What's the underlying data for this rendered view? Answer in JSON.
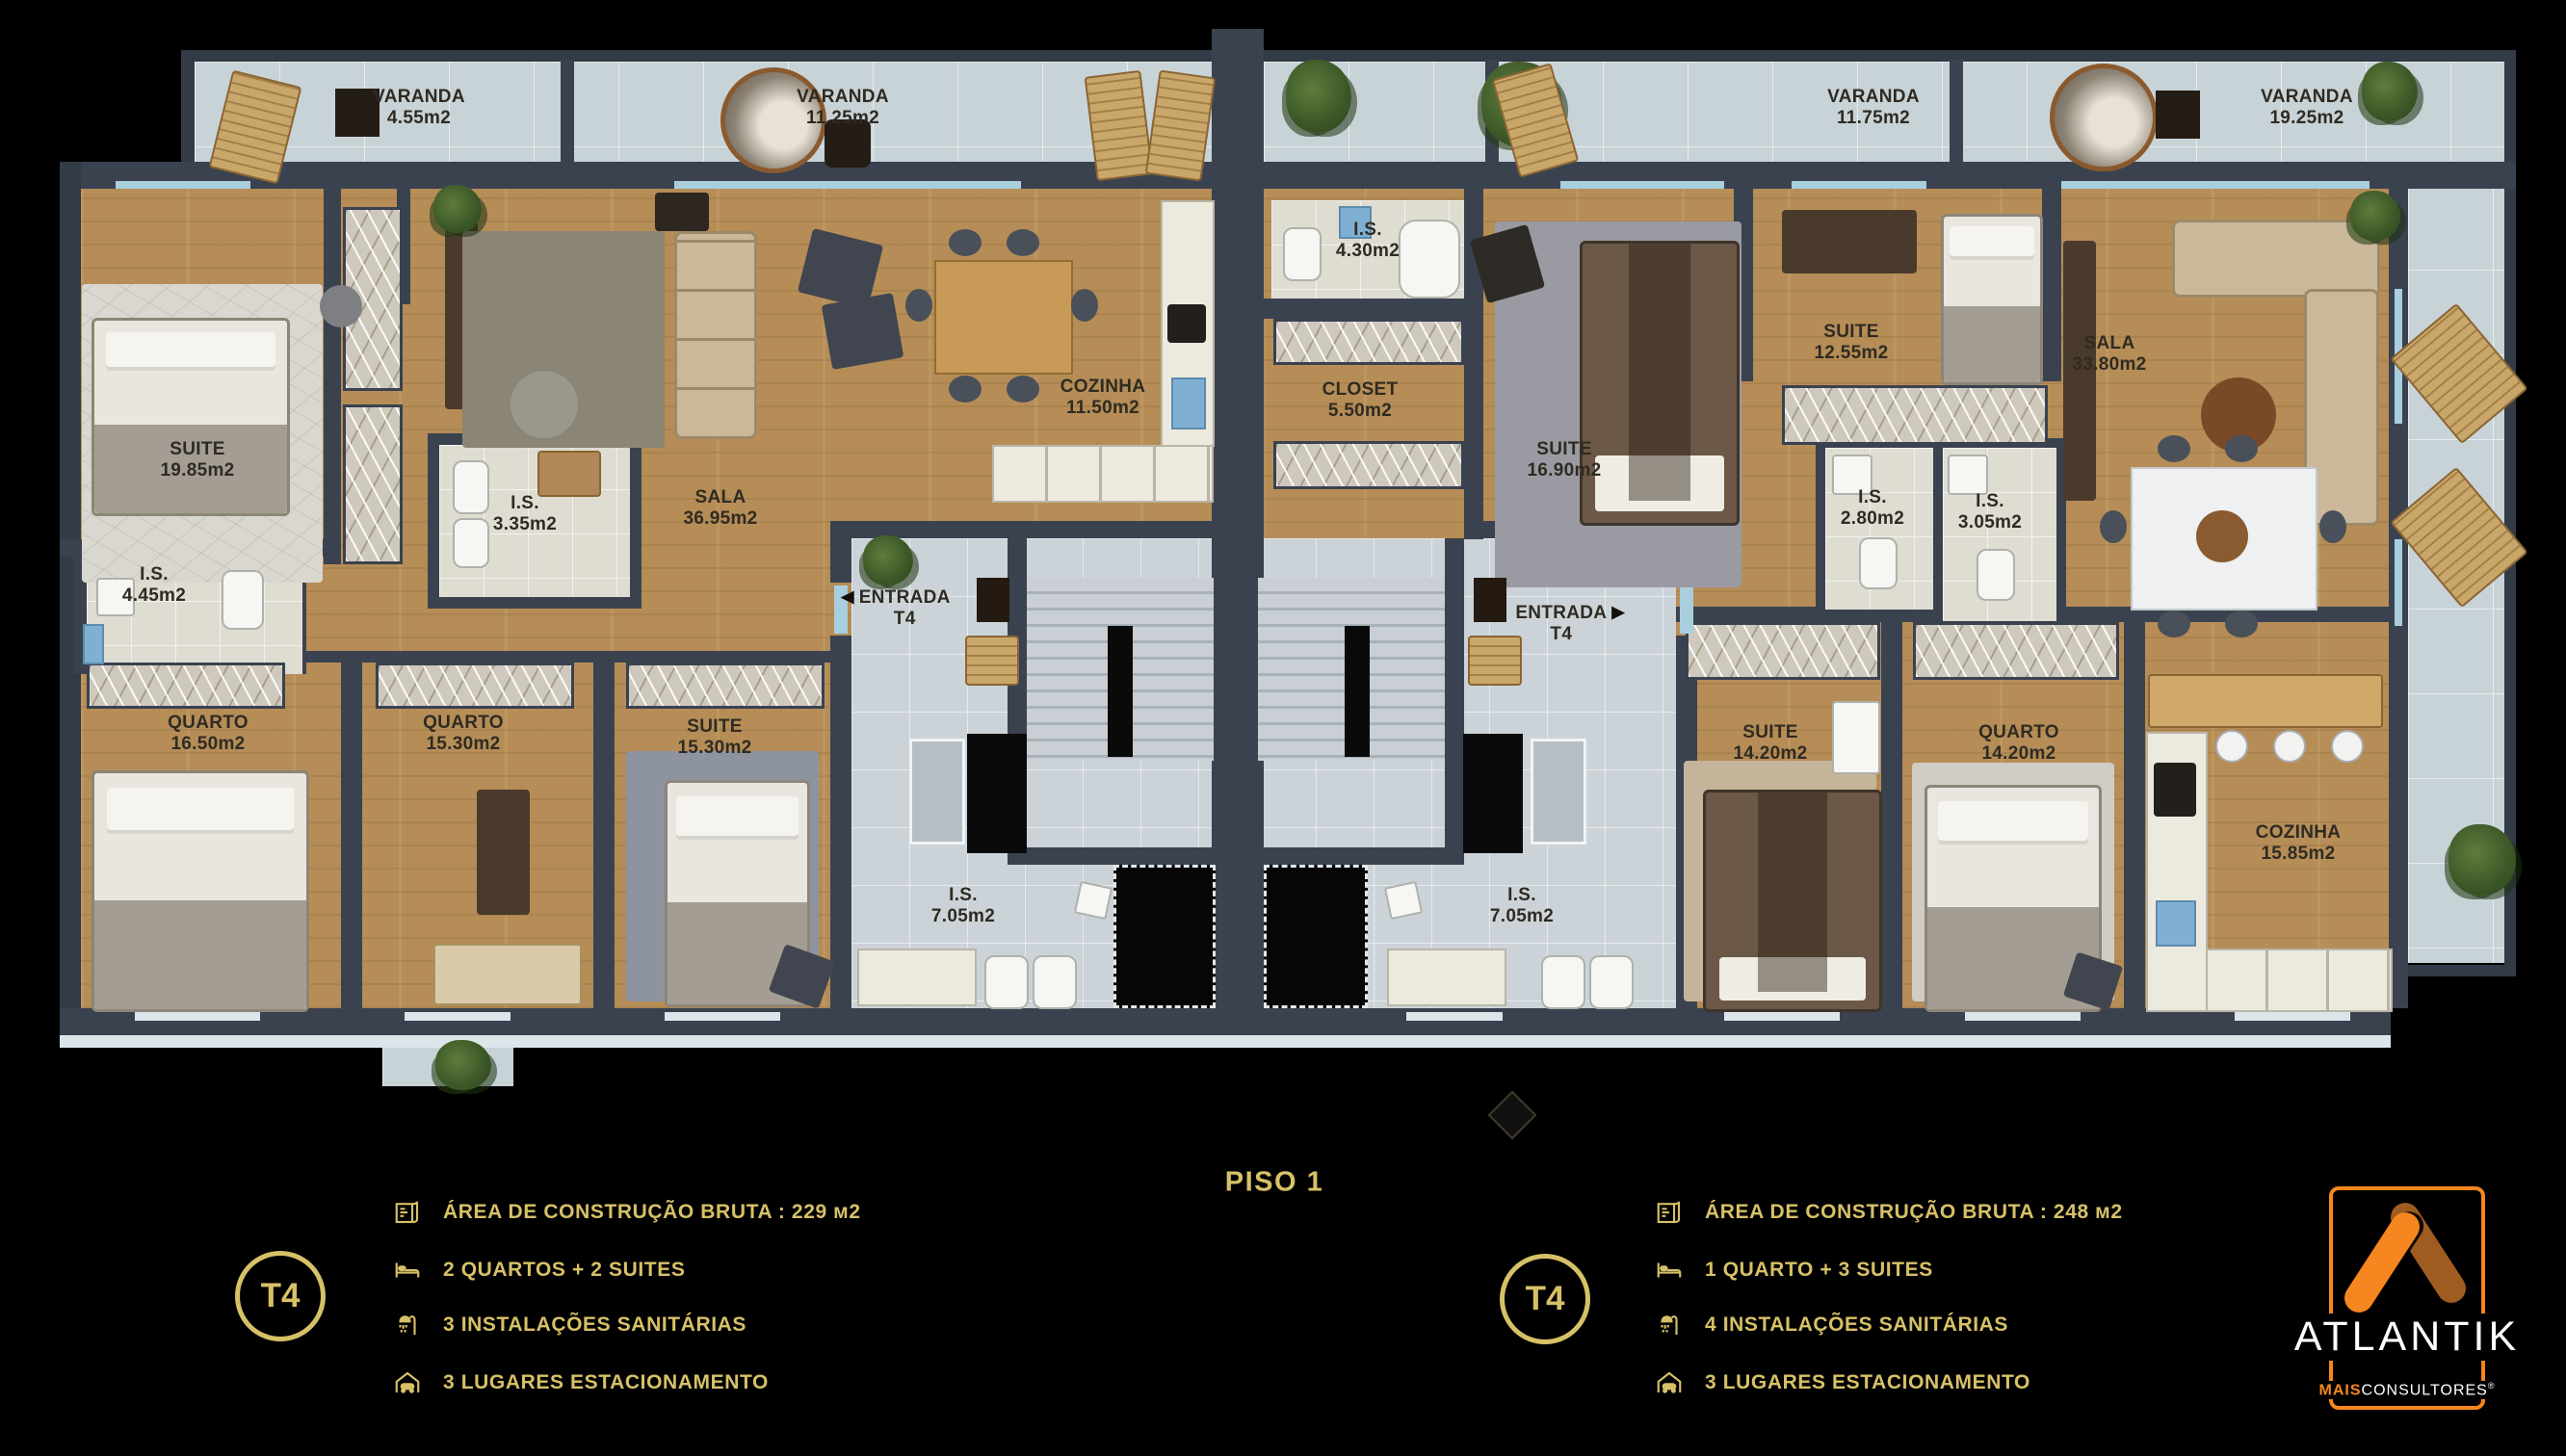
{
  "title": {
    "text": "PISO 1"
  },
  "rooms": [
    {
      "name": "VARANDA",
      "area": "4.55m2"
    },
    {
      "name": "VARANDA",
      "area": "11.25m2"
    },
    {
      "name": "VARANDA",
      "area": "11.75m2"
    },
    {
      "name": "VARANDA",
      "area": "19.25m2"
    },
    {
      "name": "SUITE",
      "area": "19.85m2"
    },
    {
      "name": "I.S.",
      "area": "4.45m2"
    },
    {
      "name": "I.S.",
      "area": "3.35m2"
    },
    {
      "name": "SALA",
      "area": "36.95m2"
    },
    {
      "name": "COZINHA",
      "area": "11.50m2"
    },
    {
      "name": "QUARTO",
      "area": "16.50m2"
    },
    {
      "name": "QUARTO",
      "area": "15.30m2"
    },
    {
      "name": "SUITE",
      "area": "15.30m2"
    },
    {
      "name": "I.S.",
      "area": "7.05m2"
    },
    {
      "name": "I.S.",
      "area": "4.30m2"
    },
    {
      "name": "CLOSET",
      "area": "5.50m2"
    },
    {
      "name": "SUITE",
      "area": "16.90m2"
    },
    {
      "name": "SUITE",
      "area": "12.55m2"
    },
    {
      "name": "I.S.",
      "area": "2.80m2"
    },
    {
      "name": "I.S.",
      "area": "3.05m2"
    },
    {
      "name": "SALA",
      "area": "33.80m2"
    },
    {
      "name": "ENTRADA",
      "area": "T4"
    },
    {
      "name": "ENTRADA",
      "area": "T4"
    },
    {
      "name": "SUITE",
      "area": "14.20m2"
    },
    {
      "name": "QUARTO",
      "area": "14.20m2"
    },
    {
      "name": "I.S.",
      "area": "7.05m2"
    },
    {
      "name": "COZINHA",
      "area": "15.85m2"
    }
  ],
  "entrada": {
    "left_arrow": "◀",
    "right_arrow": "▶"
  },
  "legend_left": {
    "badge": "T4",
    "items": [
      {
        "icon": "blueprint-icon",
        "text": "ÁREA DE CONSTRUÇÃO BRUTA :  229 м2"
      },
      {
        "icon": "bed-icon",
        "text": "2 QUARTOS + 2 SUITES"
      },
      {
        "icon": "shower-icon",
        "text": "3 INSTALAÇÕES SANITÁRIAS"
      },
      {
        "icon": "garage-icon",
        "text": "3 LUGARES ESTACIONAMENTO"
      }
    ]
  },
  "legend_right": {
    "badge": "T4",
    "items": [
      {
        "icon": "blueprint-icon",
        "text": "ÁREA DE CONSTRUÇÃO BRUTA :  248 м2"
      },
      {
        "icon": "bed-icon",
        "text": "1 QUARTO + 3 SUITES"
      },
      {
        "icon": "shower-icon",
        "text": "4 INSTALAÇÕES SANITÁRIAS"
      },
      {
        "icon": "garage-icon",
        "text": "3 LUGARES ESTACIONAMENTO"
      }
    ]
  },
  "brand": {
    "name": "ATLANTIK",
    "sub_bold": "MAIS",
    "sub_rest": "CONSULTORES",
    "registered": "®"
  },
  "colors": {
    "gold": "#d7c167",
    "orange": "#f6861f",
    "orange_dark": "#a05c20",
    "wall": "#3a4250",
    "wood": "#b68d57",
    "core_tile": "#ccd3d8",
    "bath_tile": "#dfddd2",
    "varanda_tile": "#c8d3d7"
  }
}
